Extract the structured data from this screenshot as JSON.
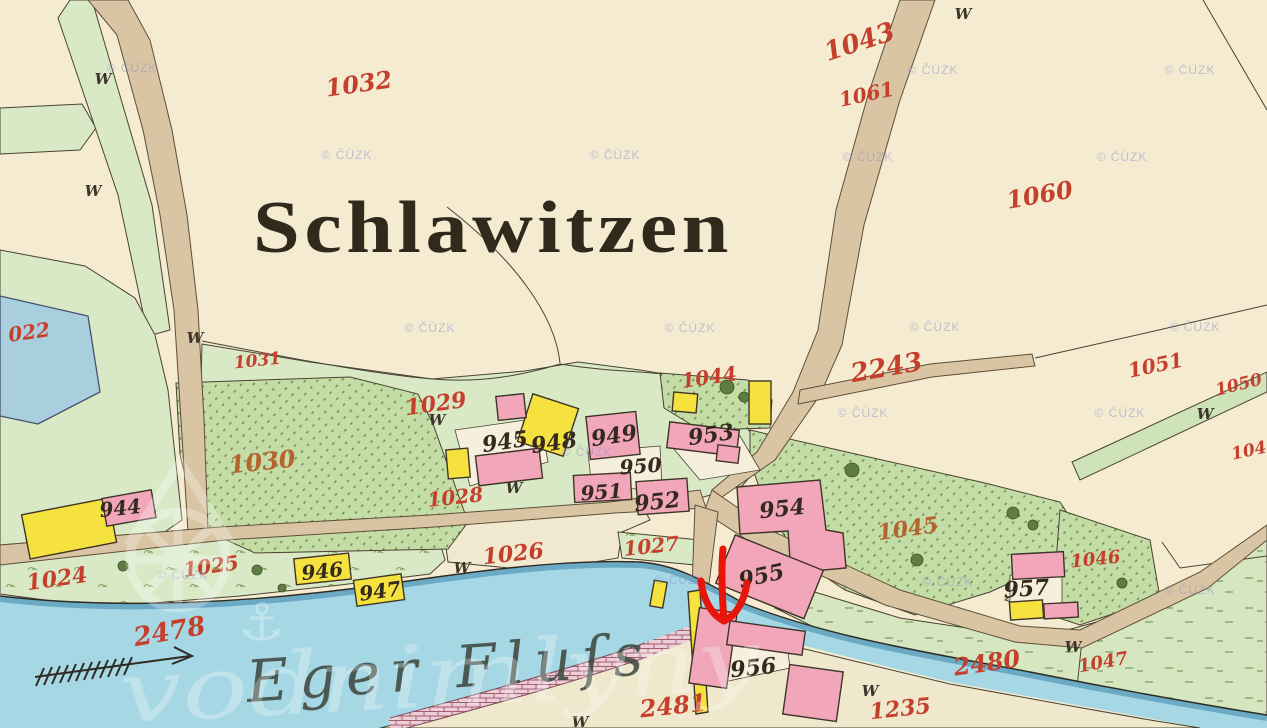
{
  "map": {
    "title": "Schlawitzen",
    "river_name": "Eger Fluſs",
    "copyright": "© ČÚZK",
    "logo_text": "vodnimlyny",
    "w_symbol": "W",
    "colors": {
      "paper": "#f4ebd1",
      "meadow": "#d9e9c6",
      "garden": "#c4dca6",
      "road": "#d9c5a3",
      "river": "#a6d7e4",
      "pond": "#a9cede",
      "building_masonry": "#f1a6ba",
      "building_wood": "#f6e23e",
      "weir_brick": "#eccdd8",
      "parcel_number_red": "#c5402c",
      "parcel_number_ochre": "#b5632f",
      "house_number_black": "#33291f",
      "annotation_arrow": "#e8150a"
    },
    "parcel_labels": [
      {
        "text": "1032",
        "x": 360,
        "y": 92,
        "r": -8,
        "s": 24
      },
      {
        "text": "1043",
        "x": 862,
        "y": 50,
        "r": -18,
        "s": 26
      },
      {
        "text": "1061",
        "x": 868,
        "y": 101,
        "r": -12,
        "s": 20
      },
      {
        "text": "1060",
        "x": 1041,
        "y": 203,
        "r": -10,
        "s": 24
      },
      {
        "text": "1031",
        "x": 258,
        "y": 366,
        "r": -6,
        "s": 17
      },
      {
        "text": "1029",
        "x": 437,
        "y": 411,
        "r": -8,
        "s": 22
      },
      {
        "text": "1030",
        "x": 263,
        "y": 470,
        "r": -6,
        "s": 24,
        "c": "#b5632f"
      },
      {
        "text": "1028",
        "x": 456,
        "y": 504,
        "r": -6,
        "s": 20
      },
      {
        "text": "1044",
        "x": 710,
        "y": 384,
        "r": -8,
        "s": 20
      },
      {
        "text": "2243",
        "x": 888,
        "y": 376,
        "r": -10,
        "s": 26
      },
      {
        "text": "1051",
        "x": 1157,
        "y": 372,
        "r": -12,
        "s": 20
      },
      {
        "text": "1050",
        "x": 1240,
        "y": 390,
        "r": -14,
        "s": 17
      },
      {
        "text": "104",
        "x": 1250,
        "y": 456,
        "r": -12,
        "s": 17
      },
      {
        "text": "1045",
        "x": 909,
        "y": 536,
        "r": -8,
        "s": 22,
        "c": "#b5632f"
      },
      {
        "text": "1046",
        "x": 1096,
        "y": 565,
        "r": -6,
        "s": 18
      },
      {
        "text": "1047",
        "x": 1104,
        "y": 668,
        "r": -10,
        "s": 18
      },
      {
        "text": "2480",
        "x": 988,
        "y": 671,
        "r": -8,
        "s": 24
      },
      {
        "text": "1024",
        "x": 58,
        "y": 586,
        "r": -8,
        "s": 22
      },
      {
        "text": "1025",
        "x": 212,
        "y": 573,
        "r": -8,
        "s": 20
      },
      {
        "text": "2478",
        "x": 171,
        "y": 640,
        "r": -10,
        "s": 26
      },
      {
        "text": "1026",
        "x": 514,
        "y": 561,
        "r": -6,
        "s": 22
      },
      {
        "text": "1027",
        "x": 652,
        "y": 553,
        "r": -6,
        "s": 20
      },
      {
        "text": "2481",
        "x": 674,
        "y": 714,
        "r": -6,
        "s": 24
      },
      {
        "text": "1235",
        "x": 901,
        "y": 716,
        "r": -6,
        "s": 22
      },
      {
        "text": "022",
        "x": 30,
        "y": 339,
        "r": -8,
        "s": 20
      }
    ],
    "house_labels": [
      {
        "text": "944",
        "x": 121,
        "y": 515,
        "r": -6,
        "s": 20
      },
      {
        "text": "945",
        "x": 506,
        "y": 449,
        "r": -8,
        "s": 22
      },
      {
        "text": "948",
        "x": 555,
        "y": 450,
        "r": -8,
        "s": 22
      },
      {
        "text": "949",
        "x": 615,
        "y": 443,
        "r": -8,
        "s": 22
      },
      {
        "text": "950",
        "x": 641,
        "y": 473,
        "r": -4,
        "s": 20
      },
      {
        "text": "951",
        "x": 602,
        "y": 499,
        "r": -4,
        "s": 20
      },
      {
        "text": "952",
        "x": 658,
        "y": 509,
        "r": -6,
        "s": 22
      },
      {
        "text": "953",
        "x": 712,
        "y": 442,
        "r": -8,
        "s": 22
      },
      {
        "text": "954",
        "x": 783,
        "y": 516,
        "r": -6,
        "s": 22
      },
      {
        "text": "955",
        "x": 763,
        "y": 583,
        "r": -12,
        "s": 22
      },
      {
        "text": "956",
        "x": 754,
        "y": 675,
        "r": -6,
        "s": 22
      },
      {
        "text": "957",
        "x": 1027,
        "y": 596,
        "r": -4,
        "s": 22
      },
      {
        "text": "946",
        "x": 323,
        "y": 578,
        "r": -6,
        "s": 20
      },
      {
        "text": "947",
        "x": 381,
        "y": 598,
        "r": -8,
        "s": 20
      }
    ],
    "w_marks": [
      {
        "x": 103,
        "y": 84
      },
      {
        "x": 93,
        "y": 196
      },
      {
        "x": 195,
        "y": 343
      },
      {
        "x": 437,
        "y": 425
      },
      {
        "x": 514,
        "y": 493
      },
      {
        "x": 462,
        "y": 573
      },
      {
        "x": 963,
        "y": 19
      },
      {
        "x": 1205,
        "y": 419
      },
      {
        "x": 1073,
        "y": 652
      },
      {
        "x": 870,
        "y": 696
      },
      {
        "x": 580,
        "y": 727
      }
    ],
    "cuzk_marks": [
      {
        "x": 132,
        "y": 72
      },
      {
        "x": 933,
        "y": 74
      },
      {
        "x": 1190,
        "y": 74
      },
      {
        "x": 347,
        "y": 159
      },
      {
        "x": 615,
        "y": 159
      },
      {
        "x": 868,
        "y": 161
      },
      {
        "x": 1122,
        "y": 161
      },
      {
        "x": 430,
        "y": 332
      },
      {
        "x": 690,
        "y": 332
      },
      {
        "x": 935,
        "y": 331
      },
      {
        "x": 1195,
        "y": 331
      },
      {
        "x": 863,
        "y": 417
      },
      {
        "x": 1120,
        "y": 417
      },
      {
        "x": 587,
        "y": 456
      },
      {
        "x": 183,
        "y": 579
      },
      {
        "x": 680,
        "y": 584
      },
      {
        "x": 948,
        "y": 586
      },
      {
        "x": 1190,
        "y": 594
      }
    ]
  }
}
